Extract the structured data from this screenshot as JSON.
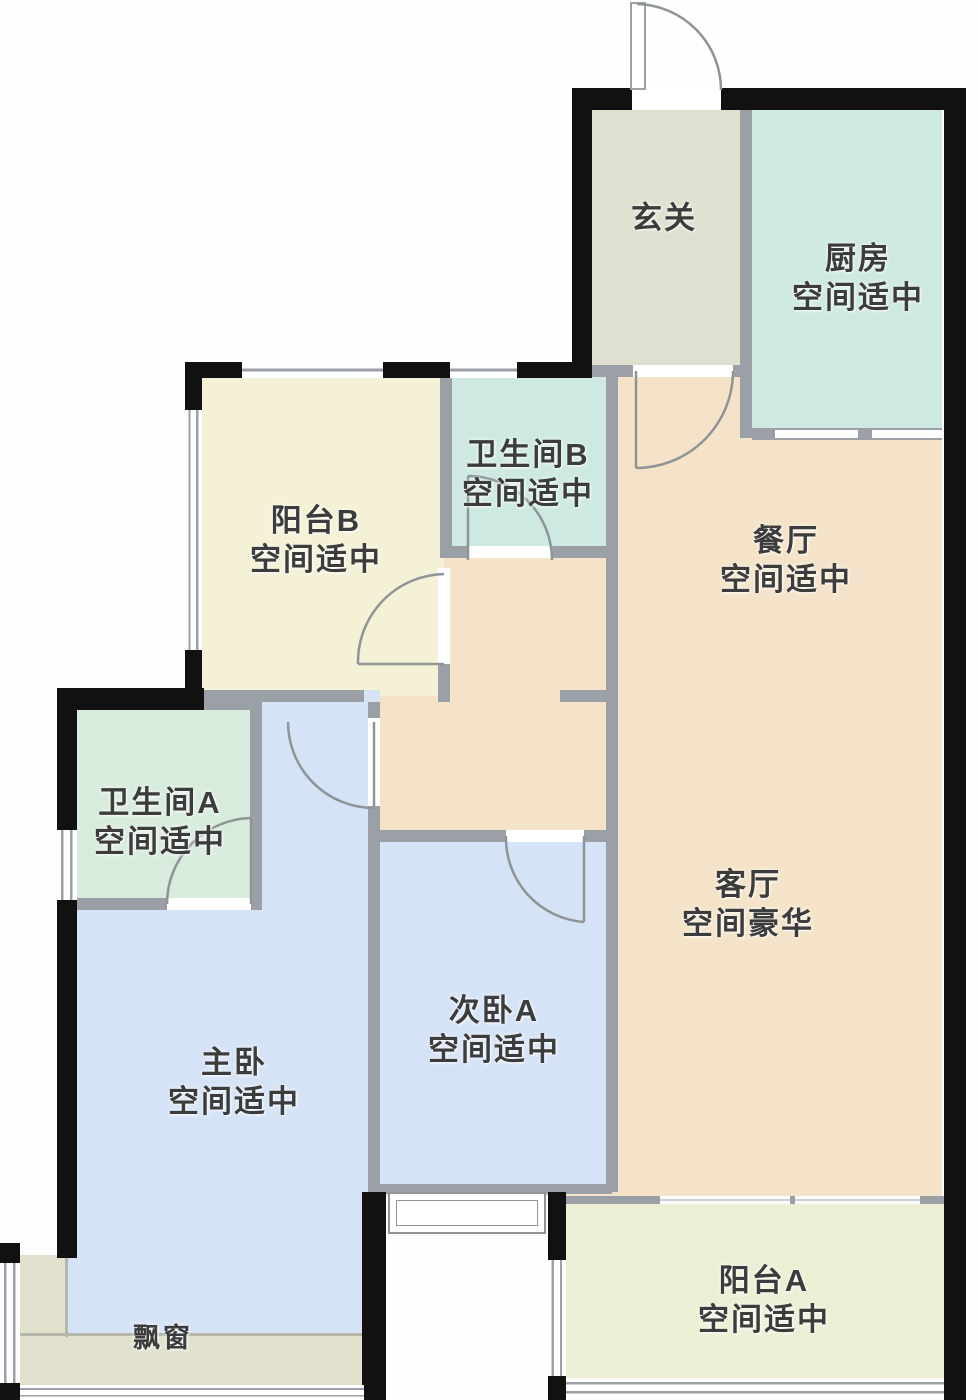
{
  "plan_type": "户型图",
  "colors": {
    "wall_black": "#111111",
    "wall_gray": "#9aa0a6",
    "door_line": "#8f9497",
    "soft_line": "#b4b7aa",
    "label_text": "#3c3c3c",
    "room_hallway": "#dfe0d0",
    "room_kitchen": "#cee9e2",
    "room_bath_a": "#d8ecdd",
    "room_bath_b": "#cde9e2",
    "room_balcony_b": "#f4f1d6",
    "room_balcony_a": "#edefd5",
    "room_bedroom": "#d5e3f7",
    "room_living": "#f4e3c8",
    "room_bay": "#e2e1cd"
  },
  "rooms": {
    "hallway": {
      "name": "玄关",
      "rating": ""
    },
    "kitchen": {
      "name": "厨房",
      "rating": "空间适中"
    },
    "bath_b": {
      "name": "卫生间B",
      "rating": "空间适中"
    },
    "balcony_b": {
      "name": "阳台B",
      "rating": "空间适中"
    },
    "dining": {
      "name": "餐厅",
      "rating": "空间适中"
    },
    "bath_a": {
      "name": "卫生间A",
      "rating": "空间适中"
    },
    "living": {
      "name": "客厅",
      "rating": "空间豪华"
    },
    "bedroom_a": {
      "name": "次卧A",
      "rating": "空间适中"
    },
    "master": {
      "name": "主卧",
      "rating": "空间适中"
    },
    "balcony_a": {
      "name": "阳台A",
      "rating": "空间适中"
    },
    "bay_window": {
      "name": "飘窗",
      "rating": ""
    }
  }
}
